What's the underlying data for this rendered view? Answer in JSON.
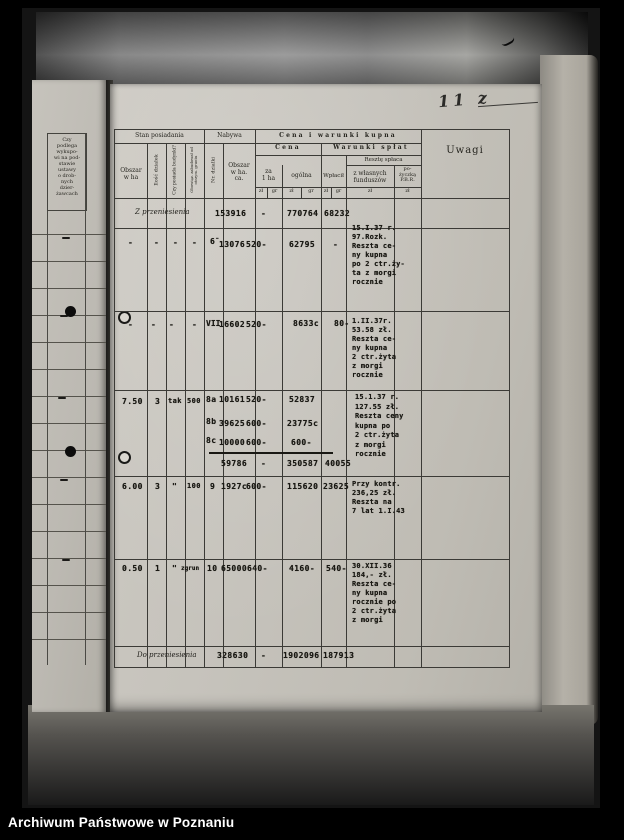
{
  "footer": {
    "label": "Archiwum Państwowe w Poznaniu"
  },
  "annotations": {
    "page_number": "11 z"
  },
  "left_page": {
    "column_header": "Czy\npodlega\nwykupo-\nwi na pod-\nstawie\nustawy\no drob-\nnych\ndzier-\nżawcach",
    "dash": "-"
  },
  "table": {
    "headers": {
      "stan_posiadania": "Stan posiadania",
      "nabywa": "Nabywa",
      "cena_i_warunki_kupna": "Cena i warunki kupna",
      "cena": "Cena",
      "warunki_splat": "Warunki spłat",
      "reszte_splaca": "Resztę spłaca",
      "obszar_w_ha": "Obszar\nw ha",
      "ilosc_dzialek": "Ilość działek",
      "czy_posiada_budynki": "Czy posiada budynki?",
      "obowiazek_zabudowy": "Obowiąz. zabudował od otrzym. gruntu",
      "nr_dzialki": "Nr. działki",
      "obszar_w_ha_ca": "Obszar\nw ha.\nca.",
      "za_1_ha": "za\n1 ha",
      "ogolna": "ogólna",
      "wplacil": "Wpłacił",
      "z_wlasnych_funduszow": "z własnych\nfunduszów",
      "pozyczka_pbr": "po-\nżyczką\nP.B.R.",
      "uwagi": "Uwagi"
    },
    "units": {
      "zl": "zł",
      "gr": "gr"
    },
    "rows": {
      "carry_in": {
        "label": "Z przeniesienia",
        "obszar": "153916",
        "za_1_ha": "-",
        "ogolna": "770764",
        "wplacil": "68232"
      },
      "r1": {
        "c1": "-",
        "c2": "-",
        "c3": "-",
        "c4": "-",
        "nr": "6̄",
        "obszar": "13076",
        "za_1_ha": "520-",
        "ogolna": "62795",
        "wplacil": "-",
        "uwagi": "15.I.37 r.\n97.Rozk.\nReszta ce-\nny kupna\npo 2 ctr.ży-\nta z morgi\nrocznie"
      },
      "r2": {
        "c1": "-",
        "c2": "-",
        "c3": "-",
        "c4": "-",
        "nr": "VII",
        "obszar": "16602",
        "za_1_ha": "520-",
        "ogolna": "8633c",
        "wplacil": "80-",
        "uwagi": "1.II.37r.\n53.58 zł.\nReszta ce-\nny kupna\n2 ctr.żyta\nz morgi\nrocznie"
      },
      "r3": {
        "c1": "7.50",
        "c2": "3",
        "c3": "tak",
        "c4": "500",
        "sub": [
          {
            "nr": "8a",
            "obszar": "10161",
            "za": "520-",
            "ogolna": "52837"
          },
          {
            "nr": "8b",
            "obszar": "39625",
            "za": "600-",
            "ogolna": "23775c"
          },
          {
            "nr": "8c",
            "obszar": "10000",
            "za": "600-",
            "ogolna": "600-"
          }
        ],
        "sum": {
          "obszar": "59786",
          "za": "-",
          "ogolna": "350587",
          "wplacil": "40055"
        },
        "uwagi": "15.1.37 r.\n127.55 zł.\nReszta ceny\nkupna po\n2 ctr.żyta\nz morgi\nrocznie"
      },
      "r4": {
        "c1": "6.00",
        "c2": "3",
        "c3": "\"",
        "c4": "100",
        "nr": "9",
        "obszar": "1927c",
        "za_1_ha": "600-",
        "ogolna": "115620",
        "wplacil": "23625",
        "uwagi": "Przy kontr.\n236,25 zł.\nReszta na\n7 lat 1.I.43"
      },
      "r5": {
        "c1": "0.50",
        "c2": "1",
        "c3": "\"",
        "c4": "zgrun",
        "nr": "10",
        "obszar": "65000",
        "za_1_ha": "640-",
        "ogolna": "4160-",
        "wplacil": "540-",
        "uwagi": "30.XII.36\n184,- zł.\nReszta ce-\nny kupna\nrocznie po\n2 ctr.żyta\nz morgi"
      },
      "carry_out": {
        "label": "Do przeniesienia",
        "obszar": "328630",
        "za_1_ha": "-",
        "ogolna": "1902096",
        "wplacil": "187913"
      }
    }
  }
}
